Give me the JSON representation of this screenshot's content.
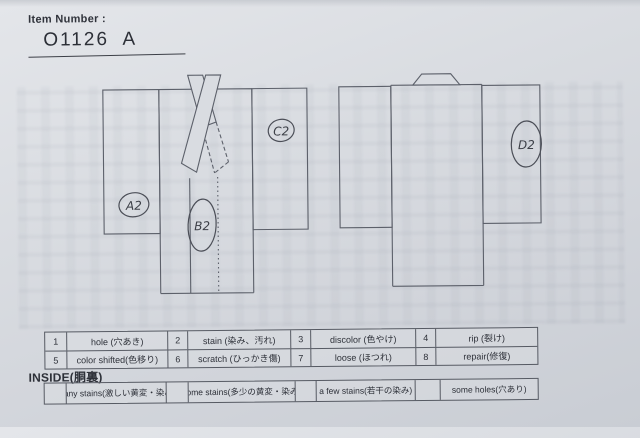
{
  "header": {
    "label": "Item Number :",
    "value": "O1126  A"
  },
  "annotations": {
    "a": "A2",
    "b": "B2",
    "c": "C2",
    "d": "D2"
  },
  "legend_table": {
    "row1": [
      {
        "num": "1",
        "label": "hole (穴あき)"
      },
      {
        "num": "2",
        "label": "stain (染み、汚れ)"
      },
      {
        "num": "3",
        "label": "discolor (色やけ)"
      },
      {
        "num": "4",
        "label": "rip (裂け)"
      }
    ],
    "row2": [
      {
        "num": "5",
        "label": "color shifted(色移り)"
      },
      {
        "num": "6",
        "label": "scratch (ひっかき傷)"
      },
      {
        "num": "7",
        "label": "loose (ほつれ)"
      },
      {
        "num": "8",
        "label": "repair(修復)"
      }
    ]
  },
  "inside_section": {
    "title": "INSIDE(胴裏)",
    "options": [
      {
        "label": "many stains(激しい黄変・染み)"
      },
      {
        "label": "some stains(多少の黄変・染み)"
      },
      {
        "label": "a few stains(若干の染み)"
      },
      {
        "label": "some holes(穴あり)"
      }
    ]
  },
  "colors": {
    "paper": "#d9dce1",
    "line": "#5c606a",
    "ink": "#4b4e57",
    "text": "#2d3038"
  }
}
